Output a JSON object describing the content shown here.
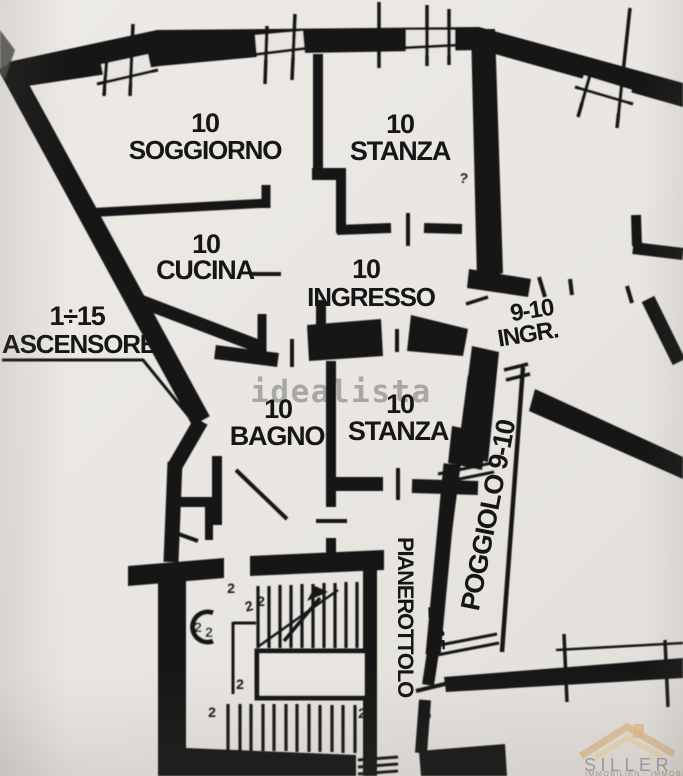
{
  "colors": {
    "paper": "#e9e6e2",
    "ink": "#171717",
    "watermark_gray": "#9a9a9a",
    "logo_tan": "#ddba8b",
    "logo_gray": "#9b9b9b"
  },
  "plan": {
    "rooms": {
      "soggiorno": {
        "number": "10",
        "name": "SOGGIORNO"
      },
      "stanza_top": {
        "number": "10",
        "name": "STANZA"
      },
      "cucina": {
        "number": "10",
        "name": "CUCINA"
      },
      "ingresso": {
        "number": "10",
        "name": "INGRESSO"
      },
      "bagno": {
        "number": "10",
        "name": "BAGNO"
      },
      "stanza_mid": {
        "number": "10",
        "name": "STANZA"
      }
    },
    "annotations": {
      "ascensore": {
        "range": "1÷15",
        "name": "ASCENSORE"
      },
      "ingresso_9_10": {
        "range": "9-10",
        "name": "INGR."
      },
      "poggiolo": {
        "label": "POGGIOLO 9-10"
      },
      "pianerottolo": {
        "label": "PIANEROTTOLO"
      },
      "stairs_range": {
        "label": "1÷15"
      }
    },
    "symbols": {
      "door_swing": "2",
      "hinge": "?"
    }
  },
  "watermarks": {
    "idealista": "idealista",
    "siller": {
      "name": "SILLER",
      "tagline": "IMMOBILIEN - IMMOBILI"
    }
  }
}
